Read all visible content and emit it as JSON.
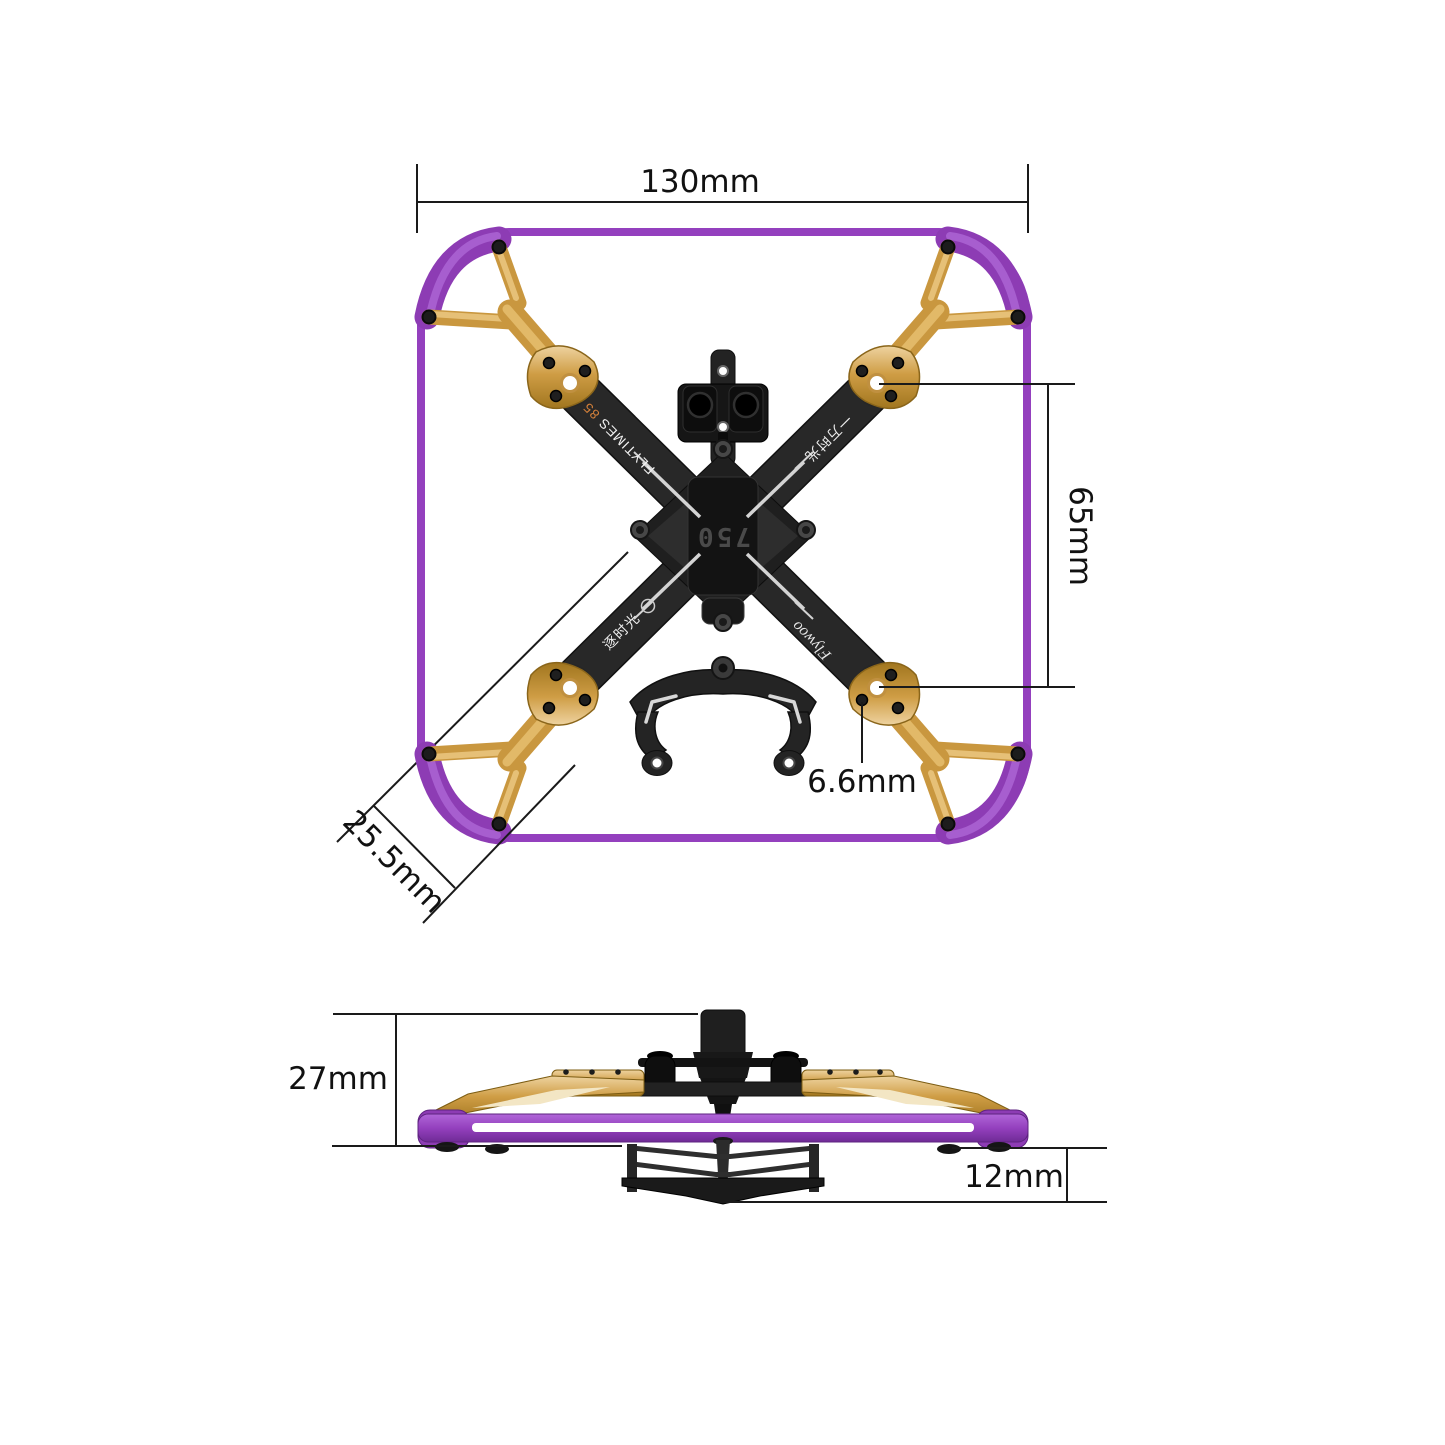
{
  "product": {
    "brand_script": "Flywoo",
    "model_label": "FLYTIMES",
    "model_number": "85",
    "center_marking": "750",
    "arm_marking_right": "一万时光",
    "arm_marking_bottom_left": "逐时光"
  },
  "dimensions": {
    "overall_width": "130mm",
    "mount_span": "65mm",
    "mount_hole": "6.6mm",
    "corner_width": "25.5mm",
    "overall_height": "27mm",
    "lower_section_height": "12mm"
  },
  "colors": {
    "bumper_purple": "#9440be",
    "arm_gold": "#cf9d45",
    "frame_black": "#262626",
    "accent_orange": "#d4803a",
    "dimension_line": "#1a1a1a"
  }
}
